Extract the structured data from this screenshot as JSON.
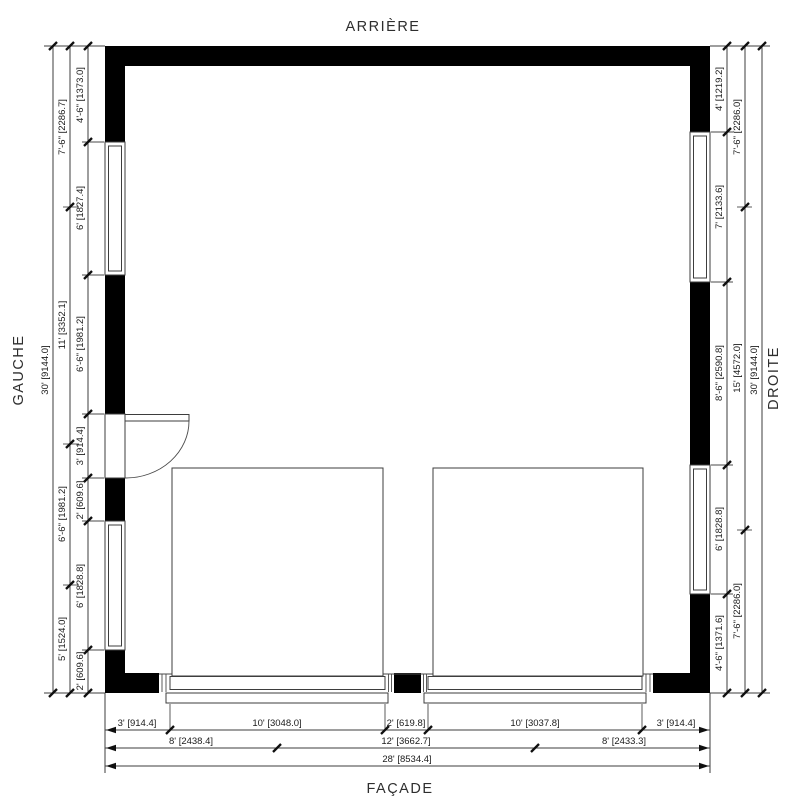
{
  "drawing": {
    "type": "floor-plan",
    "labels": {
      "top": "ARRIÈRE",
      "bottom": "FAÇADE",
      "left": "GAUCHE",
      "right": "DROITE"
    },
    "colors": {
      "wall": "#000000",
      "line": "#3d3d3d",
      "text": "#1b1b1b",
      "background": "#ffffff"
    },
    "dims": {
      "left_inner": [
        "4'-6\" [1373.0]",
        "6' [1827.4]",
        "6'-6\" [1981.2]",
        "3' [914.4]",
        "2' [609.6]",
        "6' [1828.8]",
        "2' [609.6]"
      ],
      "left_middle": [
        "7'-6\" [2286.7]",
        "11' [3352.1]",
        "6'-6\" [1981.2]",
        "5' [1524.0]"
      ],
      "left_overall": "30' [9144.0]",
      "right_inner": [
        "4' [1219.2]",
        "7' [2133.6]",
        "8'-6\" [2590.8]",
        "6' [1828.8]",
        "4'-6\" [1371.6]"
      ],
      "right_middle": [
        "7'-6\" [2286.0]",
        "15' [4572.0]",
        "7'-6\" [2286.0]"
      ],
      "right_overall": "30' [9144.0]",
      "bottom_inner": [
        "3' [914.4]",
        "10' [3048.0]",
        "2' [619.8]",
        "10' [3037.8]",
        "3' [914.4]"
      ],
      "bottom_middle": [
        "8' [2438.4]",
        "12' [3662.7]",
        "8' [2433.3]"
      ],
      "bottom_overall": "28' [8534.4]"
    }
  }
}
